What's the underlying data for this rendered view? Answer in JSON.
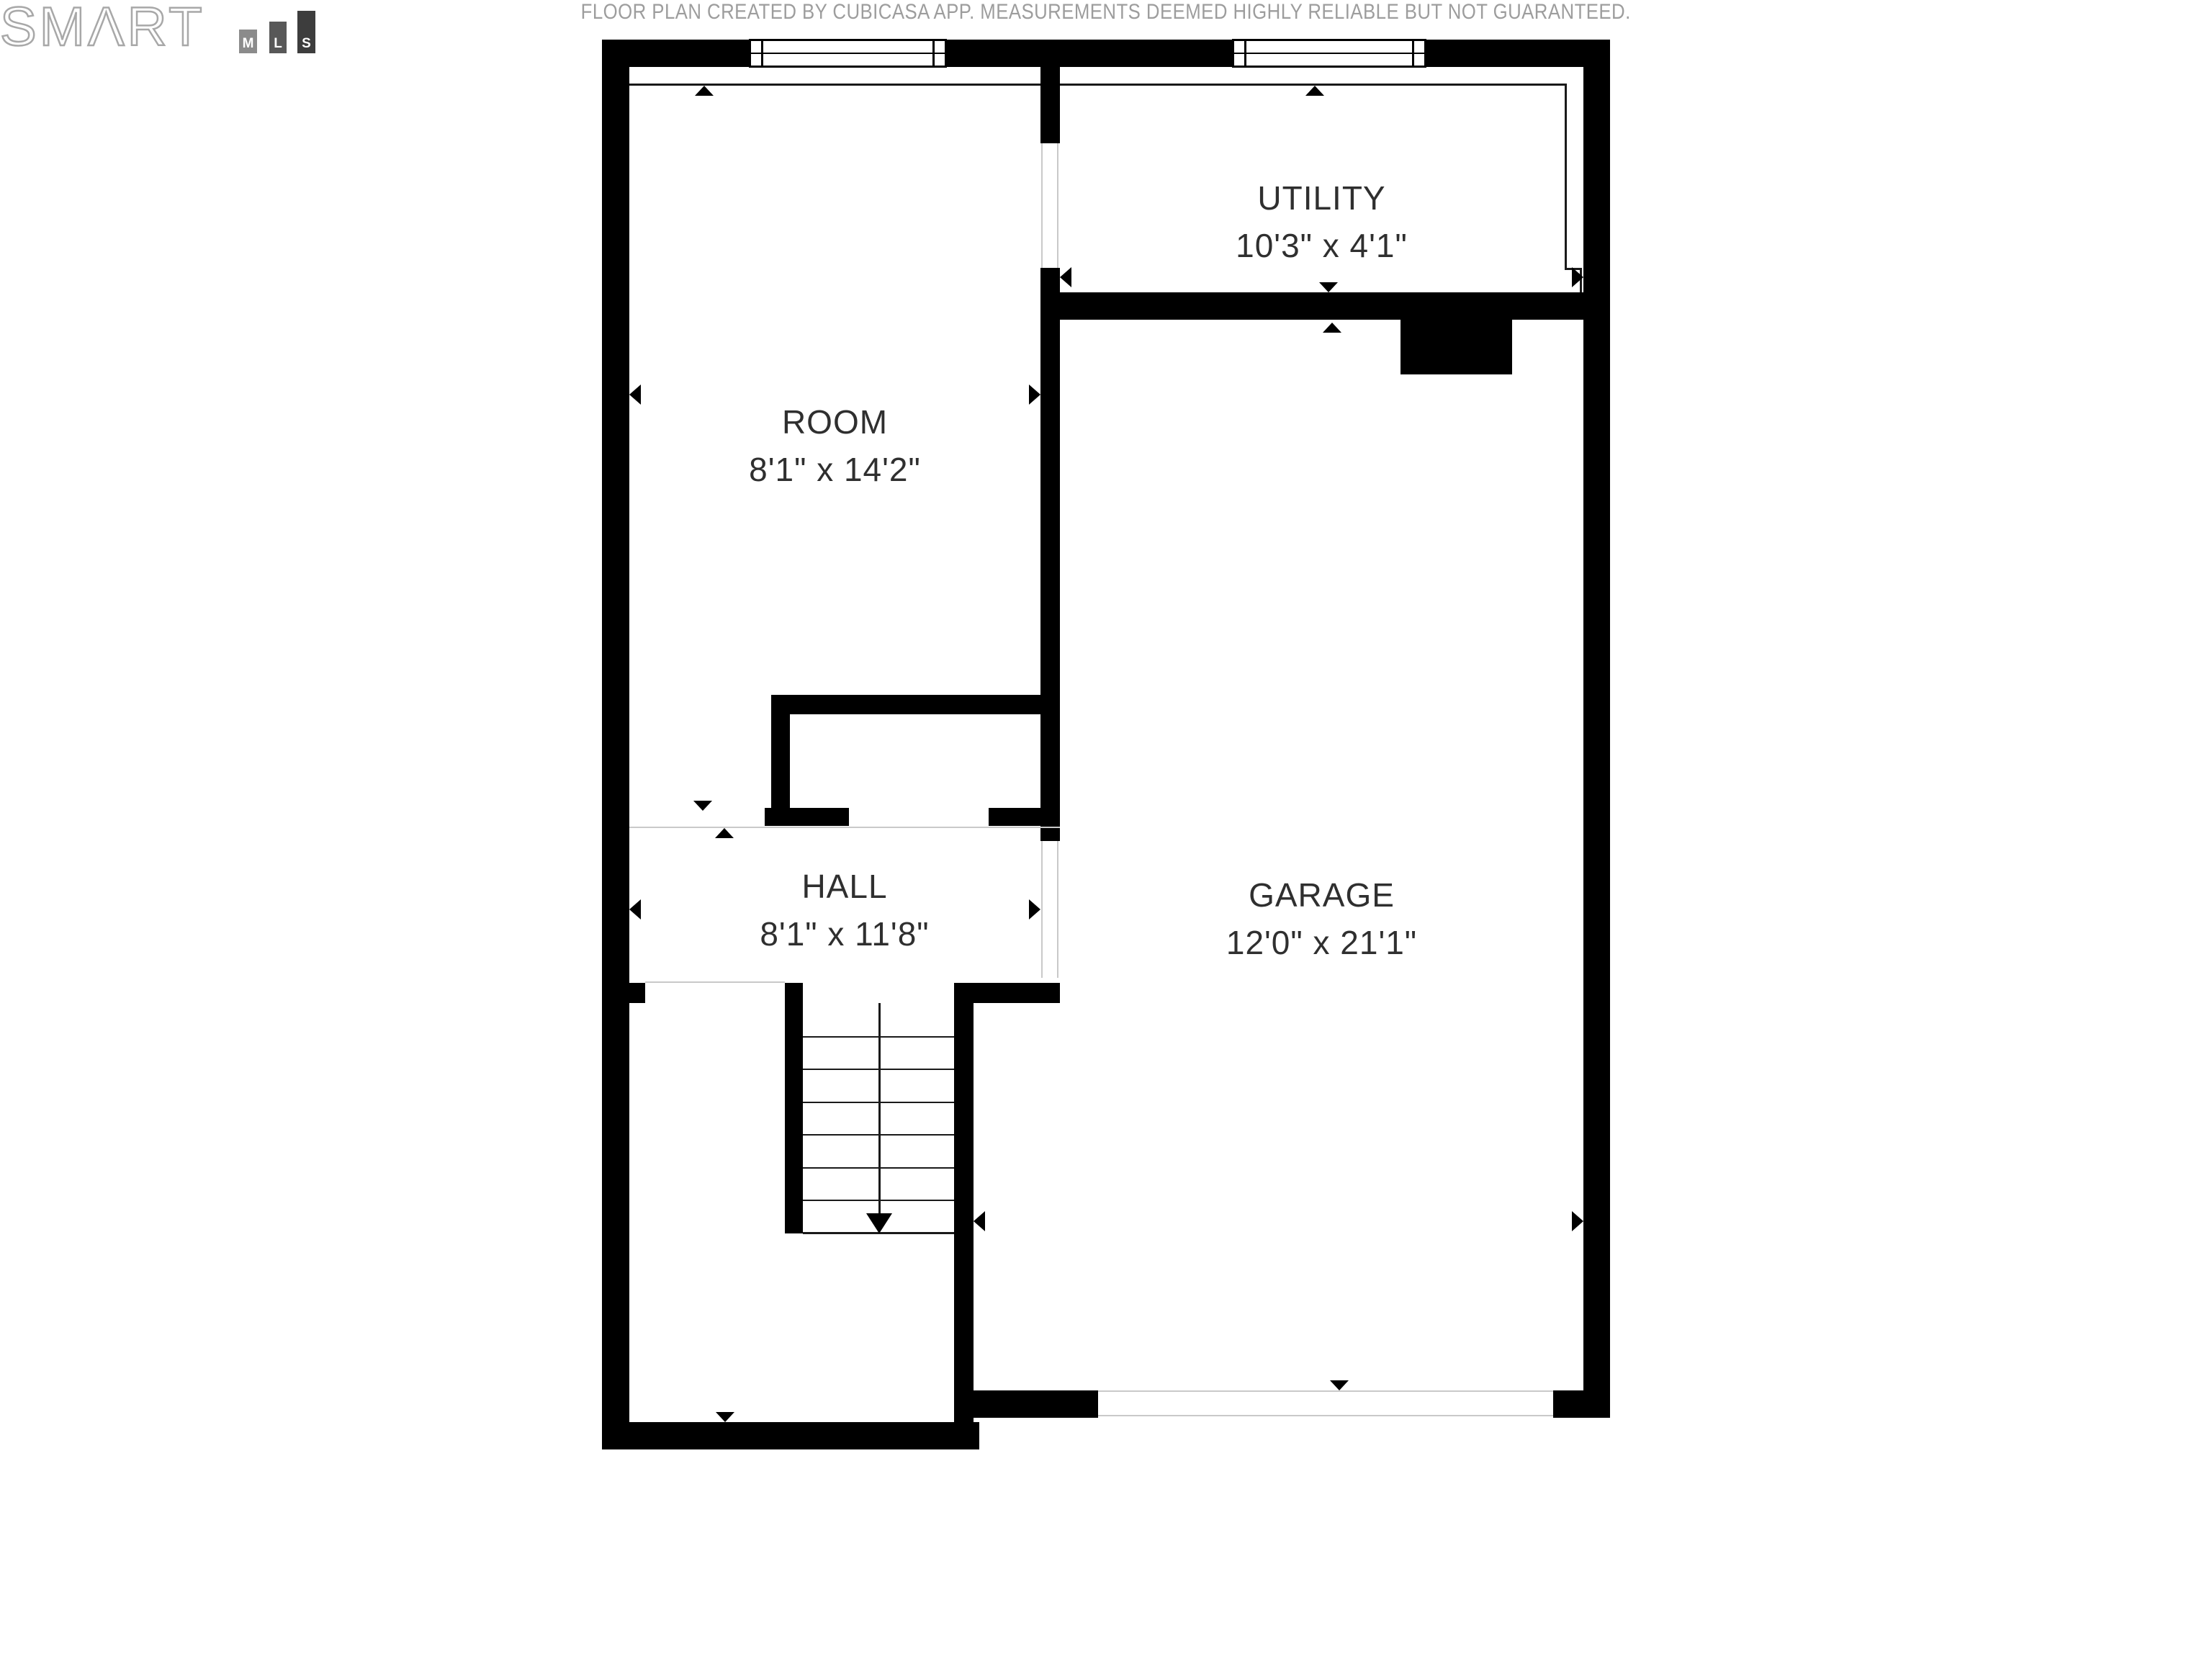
{
  "floor_plan": {
    "rooms": [
      {
        "name": "ROOM",
        "dims": "8'1\" x 14'2\""
      },
      {
        "name": "UTILITY",
        "dims": "10'3\" x 4'1\""
      },
      {
        "name": "HALL",
        "dims": "8'1\" x 11'8\""
      },
      {
        "name": "GARAGE",
        "dims": "12'0\" x 21'1\""
      }
    ]
  },
  "footer": {
    "disclaimer": "FLOOR PLAN CREATED BY CUBICASA APP. MEASUREMENTS DEEMED HIGHLY RELIABLE BUT NOT GUARANTEED."
  },
  "logo": {
    "brand": "SMΛRT",
    "bars": [
      "M",
      "L",
      "S"
    ]
  },
  "colors": {
    "wall": "#000000",
    "label_text": "#2f2f2f",
    "faint_line": "#c9c9c9",
    "footer_text": "#9d9d9d",
    "logo_outline": "#a8a8a8",
    "logo_bar_m": "#8b8b8b",
    "logo_bar_l": "#585858",
    "logo_bar_s": "#3d3d3d"
  }
}
